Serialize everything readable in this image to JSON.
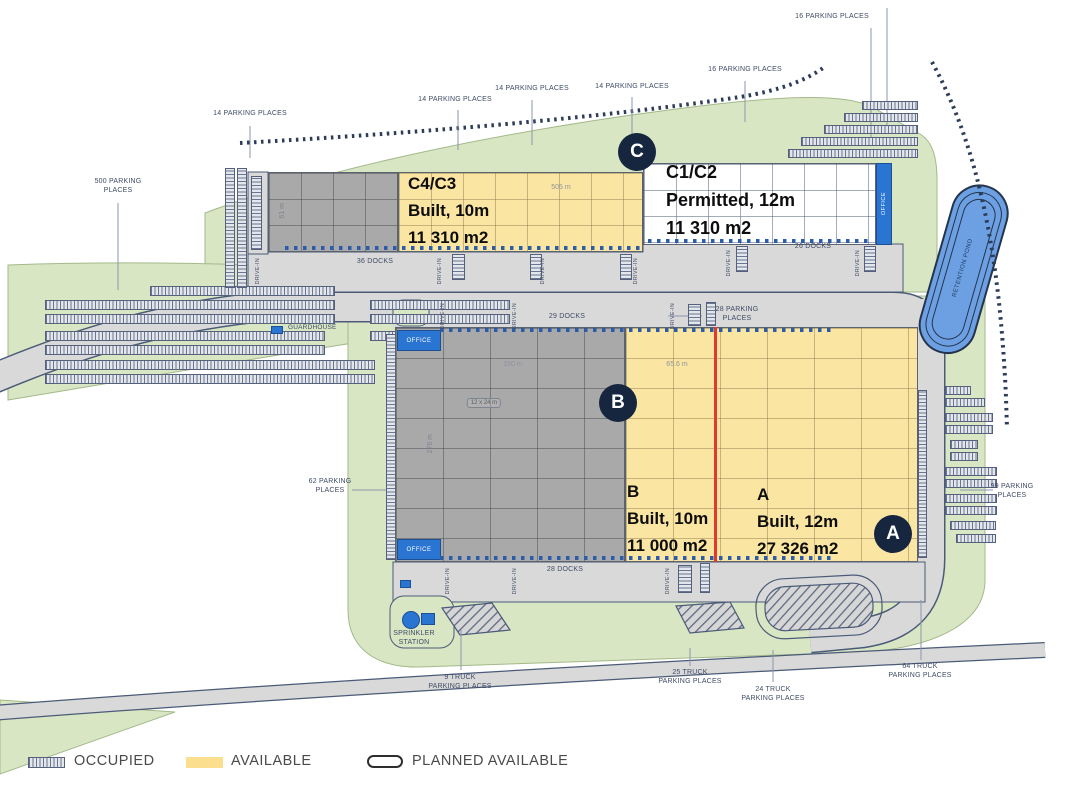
{
  "buildings": {
    "c43": {
      "name": "C4/C3",
      "status": "Built, 10m",
      "area": "11 310 m2"
    },
    "c12": {
      "name": "C1/C2",
      "status": "Permitted, 12m",
      "area": "11 310 m2"
    },
    "b": {
      "name": "B",
      "status": "Built, 10m",
      "area": "11 000 m2"
    },
    "a": {
      "name": "A",
      "status": "Built, 12m",
      "area": "27 326 m2"
    }
  },
  "badges": {
    "a": "A",
    "b": "B",
    "c": "C"
  },
  "labels": {
    "parking_500": "500 PARKING\nPLACES",
    "parking_14": "14 PARKING PLACES",
    "parking_16": "16 PARKING PLACES",
    "parking_28": "28 PARKING\nPLACES",
    "parking_62": "62 PARKING\nPLACES",
    "parking_99": "99 PARKING\nPLACES",
    "truck_9": "9 TRUCK\nPARKING PLACES",
    "truck_25": "25 TRUCK\nPARKING PLACES",
    "truck_24": "24 TRUCK\nPARKING PLACES",
    "truck_64": "64 TRUCK\nPARKING PLACES",
    "guardhouse": "GUARDHOUSE",
    "sprinkler": "SPRINKLER\nSTATION",
    "retention_pond": "RETENTION POND",
    "office": "OFFICE",
    "drive_in": "DRIVE-IN",
    "docks_36": "36 DOCKS",
    "docks_26": "26 DOCKS",
    "docks_29": "29 DOCKS",
    "docks_28": "28 DOCKS"
  },
  "dimensions": {
    "c_length": "505 m",
    "c_width": "61 m",
    "b_length": "150 m",
    "a_width": "65.6 m",
    "b_depth": "276 m",
    "bay": "12 x 24 m"
  },
  "legend": {
    "occupied": "OCCUPIED",
    "available": "AVAILABLE",
    "planned": "PLANNED AVAILABLE"
  },
  "colors": {
    "available_yellow": "#fbe5a2",
    "occupied_gray": "#a9a9a9",
    "planned_white": "#ffffff",
    "office_blue": "#2a75d2",
    "pond_blue": "#6ca0e2",
    "badge_navy": "#16263f",
    "divider_red": "#e0392f",
    "site_green": "#d9e6c4",
    "road_gray": "#d9d9d9"
  }
}
